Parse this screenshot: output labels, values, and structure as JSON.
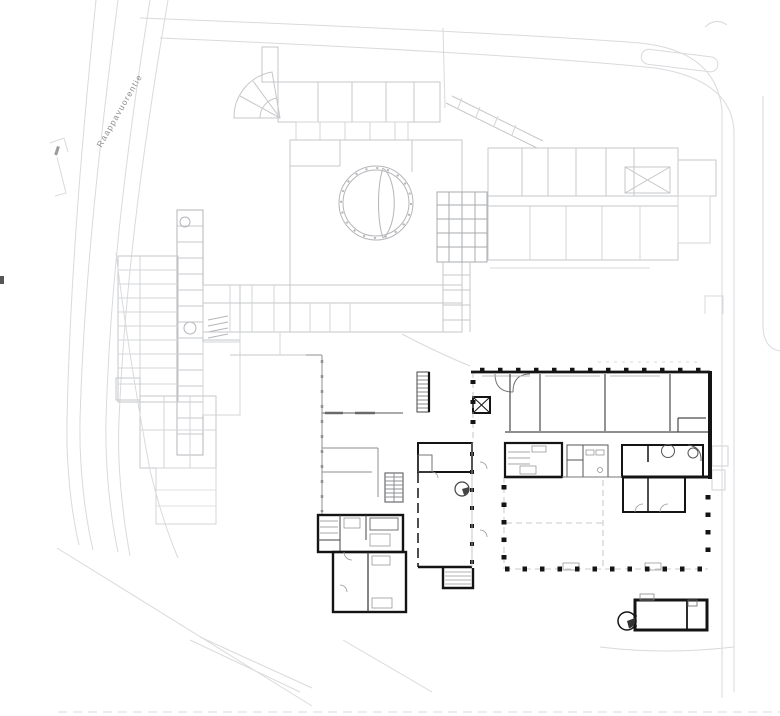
{
  "street": {
    "label": "Raappavuorentie"
  },
  "colors": {
    "background": "#ffffff",
    "road": "#d9dadd",
    "road_light": "#e3e4e7",
    "existing": "#c6c7ca",
    "existing_light": "#dcdde0",
    "existing_medium": "#aaabae",
    "interior_gray": "#555555",
    "mid_gray": "#8e8f92",
    "new_dark": "#141414",
    "label_text": "#8f9094"
  }
}
